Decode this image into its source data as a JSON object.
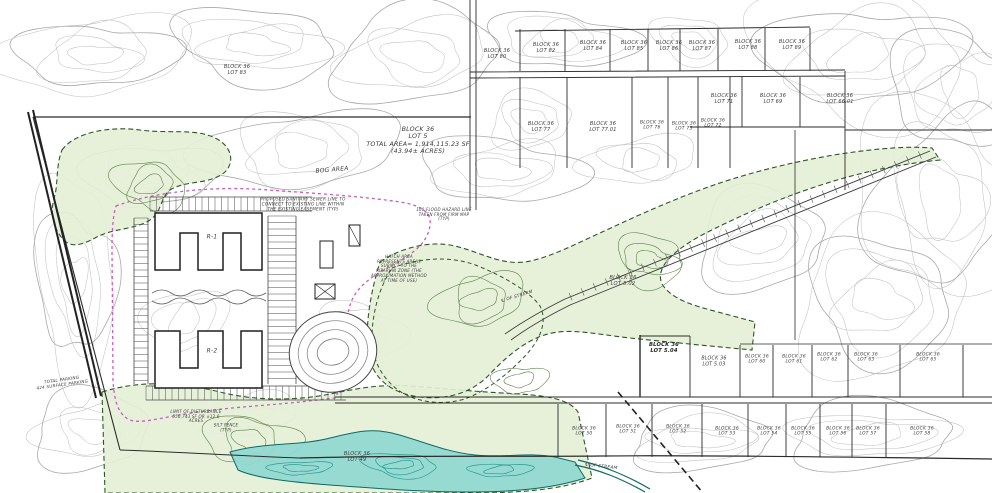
{
  "primary_parcel": {
    "block": "BLOCK 36",
    "lot": "LOT 5",
    "total_area_sf": "1,914,115.23 SF",
    "total_area_acres": "(43.94± ACRES)"
  },
  "colors": {
    "wetland_green": "#e4efd6",
    "wetland_outline_green": "#2e5526",
    "stream_teal": "#92d8d2",
    "stream_outline_teal": "#0c6b64",
    "disturbance_magenta": "#c55fc0",
    "contour_gray": "#c2c2c2",
    "boundary_black": "#2b2b2b"
  },
  "map_labels": [
    {
      "id": "lot-80",
      "text": "BLOCK 36\nLOT 80"
    },
    {
      "id": "lot-82",
      "text": "BLOCK 36\nLOT 82"
    },
    {
      "id": "lot-84",
      "text": "BLOCK 36\nLOT 84"
    },
    {
      "id": "lot-85",
      "text": "BLOCK 36\nLOT 85"
    },
    {
      "id": "lot-86",
      "text": "BLOCK 36\nLOT 86"
    },
    {
      "id": "lot-87",
      "text": "BLOCK 36\nLOT 87"
    },
    {
      "id": "lot-88",
      "text": "BLOCK 36\nLOT 88"
    },
    {
      "id": "lot-89",
      "text": "BLOCK 36\nLOT 89"
    },
    {
      "id": "lot-83",
      "text": "BLOCK 36\nLOT 83"
    },
    {
      "id": "lot-71",
      "text": "BLOCK 36\nLOT 71"
    },
    {
      "id": "lot-69",
      "text": "BLOCK 36\nLOT 69"
    },
    {
      "id": "lot-66-01",
      "text": "BLOCK 36\nLOT 66.01"
    },
    {
      "id": "lot-77",
      "text": "BLOCK 36\nLOT 77"
    },
    {
      "id": "lot-77-01",
      "text": "BLOCK 36\nLOT 77.01"
    },
    {
      "id": "lot-76",
      "text": "BLOCK 36\nLOT 76"
    },
    {
      "id": "lot-73",
      "text": "BLOCK 36\nLOT 73"
    },
    {
      "id": "lot-72",
      "text": "BLOCK 36\nLOT 72"
    },
    {
      "id": "lot-5-main",
      "text": "BLOCK 36\nLOT 5\nTOTAL AREA= 1,914,115.23 SF\n(43.94± ACRES)"
    },
    {
      "id": "bog-area",
      "text": "BOG AREA"
    },
    {
      "id": "sewer-note",
      "text": "PROPOSED SANITARY SEWER LINE TO\nCONNECT TO EXISTING LINE WITHIN\nTHE EXISTING EASEMENT (TYP)"
    },
    {
      "id": "flood-note",
      "text": "100 FLOOD HAZARD LINE\nTAKEN FROM FIRM MAP\n(TYP)"
    },
    {
      "id": "riparian-note",
      "text": "HATCH AREA\nREPRESENTS AREAS\nSUBJECT TO THE\nRIPARIAN ZONE (THE\nAPPROXIMATION METHOD\nAT TIME OF USE)"
    },
    {
      "id": "building-r1",
      "text": "R-1"
    },
    {
      "id": "building-r2",
      "text": "R-2"
    },
    {
      "id": "lot-5-02",
      "text": "BLOCK 36\nLOT 5.02"
    },
    {
      "id": "stream-centerline-mid",
      "text": "℄ OF STREAM"
    },
    {
      "id": "stream-centerline-south",
      "text": "℄ OF STREAM"
    },
    {
      "id": "lot-5-04",
      "text": "BLOCK 36\nLOT 5.04"
    },
    {
      "id": "lot-5-03",
      "text": "BLOCK 36\nLOT 5.03"
    },
    {
      "id": "lot-60",
      "text": "BLOCK 36\nLOT 60"
    },
    {
      "id": "lot-61",
      "text": "BLOCK 36\nLOT 61"
    },
    {
      "id": "lot-62",
      "text": "BLOCK 36\nLOT 62"
    },
    {
      "id": "lot-63",
      "text": "BLOCK 36\nLOT 63"
    },
    {
      "id": "lot-65",
      "text": "BLOCK 36\nLOT 65"
    },
    {
      "id": "lot-50",
      "text": "BLOCK 36\nLOT 50"
    },
    {
      "id": "lot-51",
      "text": "BLOCK 36\nLOT 51"
    },
    {
      "id": "lot-52",
      "text": "BLOCK 36\nLOT 52"
    },
    {
      "id": "lot-53",
      "text": "BLOCK 36\nLOT 53"
    },
    {
      "id": "lot-54",
      "text": "BLOCK 36\nLOT 54"
    },
    {
      "id": "lot-55",
      "text": "BLOCK 36\nLOT 55"
    },
    {
      "id": "lot-56",
      "text": "BLOCK 36\nLOT 56"
    },
    {
      "id": "lot-57",
      "text": "BLOCK 36\nLOT 57"
    },
    {
      "id": "lot-58",
      "text": "BLOCK 36\nLOT 58"
    },
    {
      "id": "lot-49",
      "text": "BLOCK 36\nLOT 49"
    },
    {
      "id": "parking-note",
      "text": "TOTAL PARKING\n424 SURFACE PARKING"
    },
    {
      "id": "disturbance-note",
      "text": "LIMIT OF DISTURBANCE\n550,743 SF OR ±12.6\nACRES"
    },
    {
      "id": "silt-fence-note",
      "text": "SILT FENCE\n(TYP)"
    }
  ]
}
